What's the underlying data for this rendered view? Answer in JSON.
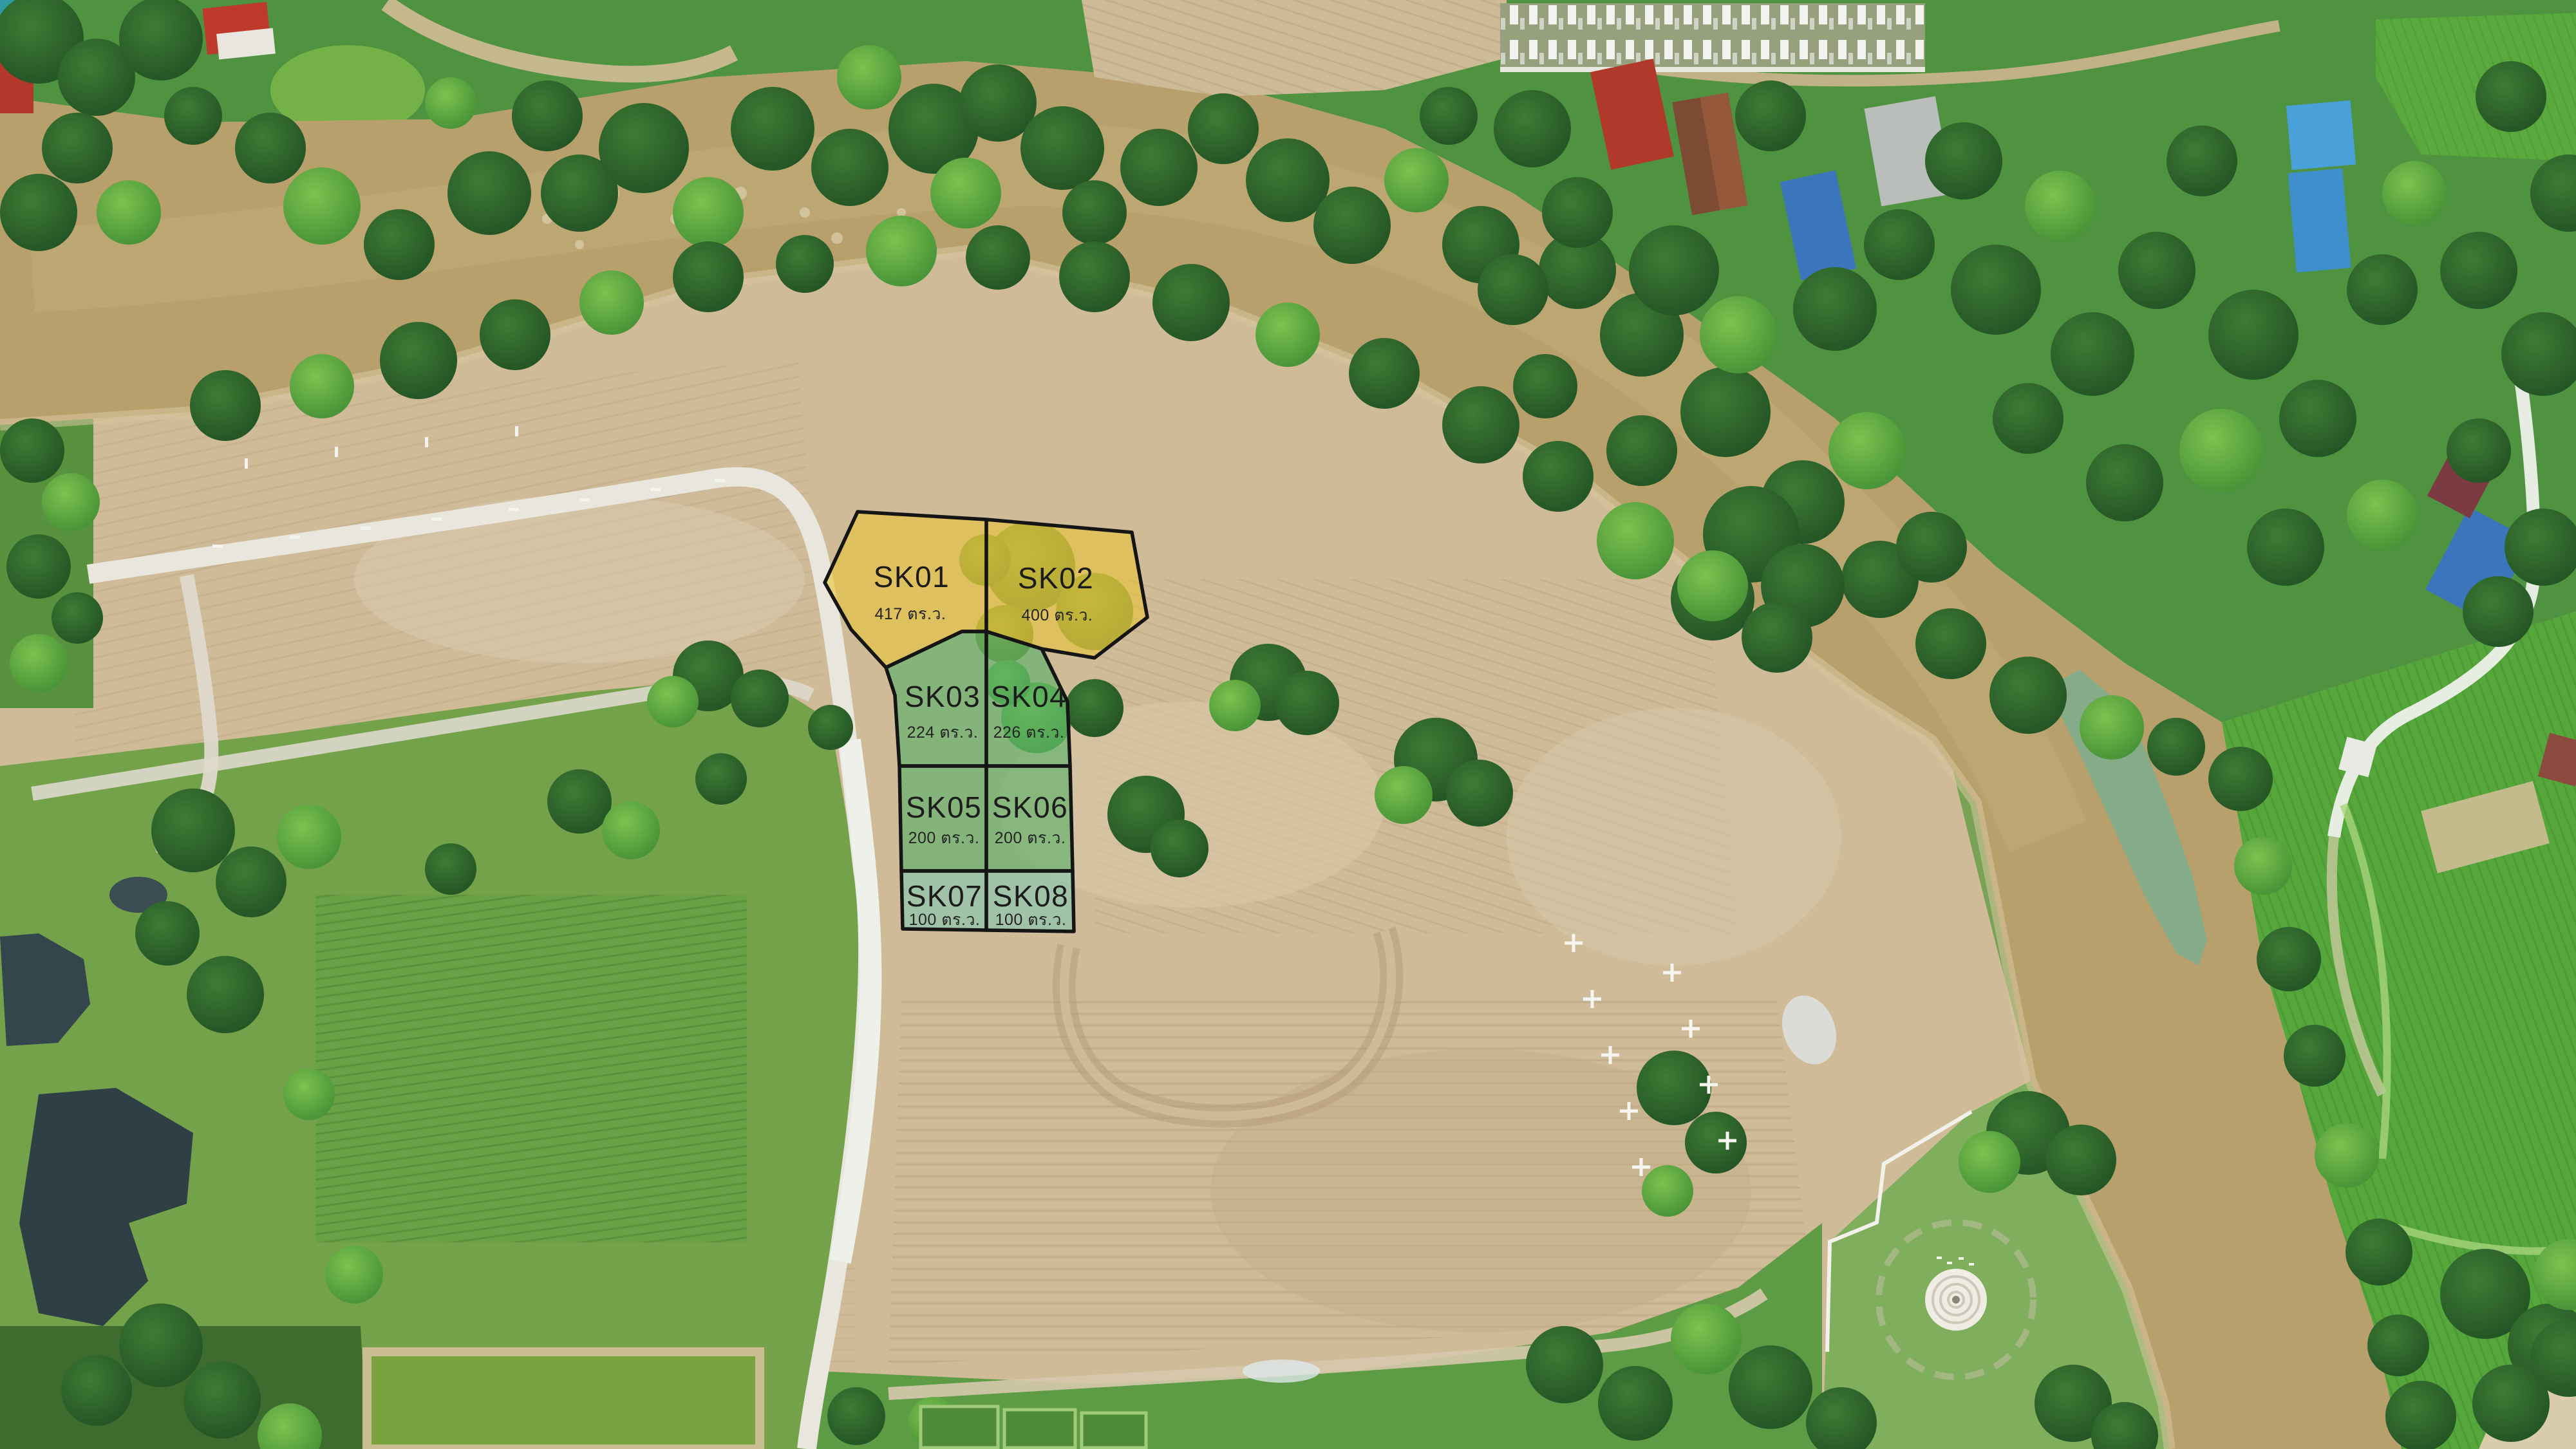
{
  "scene": {
    "description": "Aerial drone photo of riverside land subdivision with eight marked plots",
    "unit_label": "ตร.ว.",
    "plots": [
      {
        "id": "SK01",
        "area": "417",
        "area_label": "417 ตร.ว.",
        "fill": "#e7c53a"
      },
      {
        "id": "SK02",
        "area": "400",
        "area_label": "400 ตร.ว.",
        "fill": "#e7c53a"
      },
      {
        "id": "SK03",
        "area": "224",
        "area_label": "224 ตร.ว.",
        "fill": "#57b068"
      },
      {
        "id": "SK04",
        "area": "226",
        "area_label": "226 ตร.ว.",
        "fill": "#57b068"
      },
      {
        "id": "SK05",
        "area": "200",
        "area_label": "200 ตร.ว.",
        "fill": "#57b068"
      },
      {
        "id": "SK06",
        "area": "200",
        "area_label": "200 ตร.ว.",
        "fill": "#57b068"
      },
      {
        "id": "SK07",
        "area": "100",
        "area_label": "100 ตร.ว.",
        "fill": "#83c8b0"
      },
      {
        "id": "SK08",
        "area": "100",
        "area_label": "100 ตร.ว.",
        "fill": "#83c8b0"
      }
    ],
    "colors": {
      "river": "#b7a06b",
      "dirt": "#cfbb98",
      "vegetation": "#4f9340",
      "plot_outline": "#151515",
      "label_text": "#1c1c1c",
      "yellow_plot": "#e7c53a",
      "green_plot": "#57b068",
      "teal_plot": "#83c8b0"
    }
  }
}
